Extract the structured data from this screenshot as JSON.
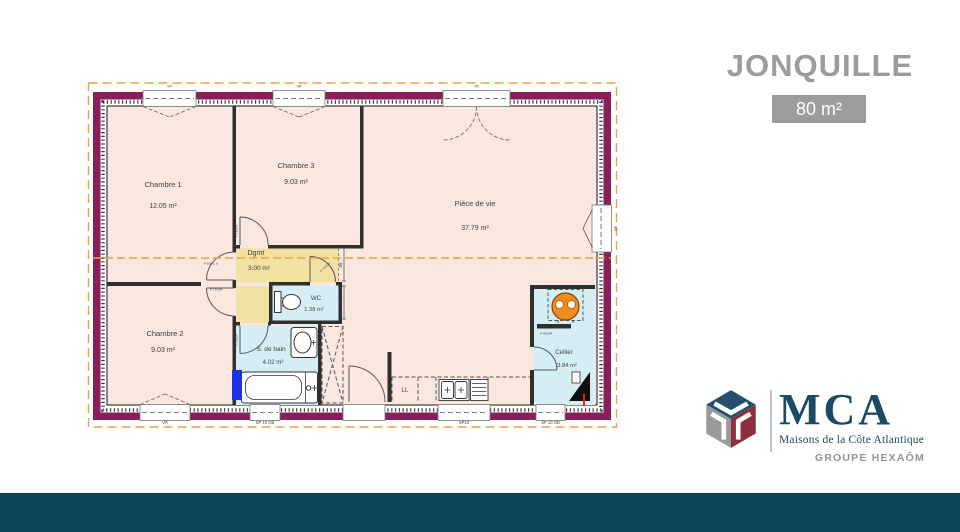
{
  "header": {
    "model_name": "JONQUILLE",
    "area_badge": "80 m²"
  },
  "branding": {
    "acronym": "MCA",
    "subtitle": "Maisons de la Côte Atlantique",
    "group": "GROUPE HEXAÔM"
  },
  "floorplan": {
    "rooms": {
      "chambre1": {
        "name": "Chambre 1",
        "area": "12.05 m²"
      },
      "chambre3": {
        "name": "Chambre 3",
        "area": "9.03 m²"
      },
      "piece_de_vie": {
        "name": "Pièce de vie",
        "area": "37.79 m²"
      },
      "dgmt": {
        "name": "Dgmt",
        "area": "3.00 m²"
      },
      "wc": {
        "name": "WC",
        "area": "1.38 m²"
      },
      "chambre2": {
        "name": "Chambre 2",
        "area": "9.03 m²"
      },
      "sdb": {
        "name": "S. de bain",
        "area": "4.02 m²"
      },
      "cellier": {
        "name": "Cellier",
        "area": "3.84 m²"
      }
    },
    "labels": {
      "vr": "VR",
      "sp10ob": "SP 10 OB",
      "sp10": "SP10",
      "ll": "LL",
      "door_std": "P 73/204",
      "door_ch1": "P 60/EL d",
      "door_cellier": "P 83/204",
      "dim": "85"
    },
    "colors": {
      "wall": "#8a1e59",
      "room_fill": "#f9e7e0",
      "wet_room_fill": "#d5eef4",
      "hall_fill": "#f2e2a2",
      "perimeter_dash": "#f59d45",
      "window_blue": "#1a35e0",
      "heater_orange": "#f28a1d",
      "teal_bar": "#0c4458",
      "title_gray": "#9c9c9c",
      "brand_navy": "#1c4a63",
      "brand_red": "#8e2f3f"
    }
  }
}
